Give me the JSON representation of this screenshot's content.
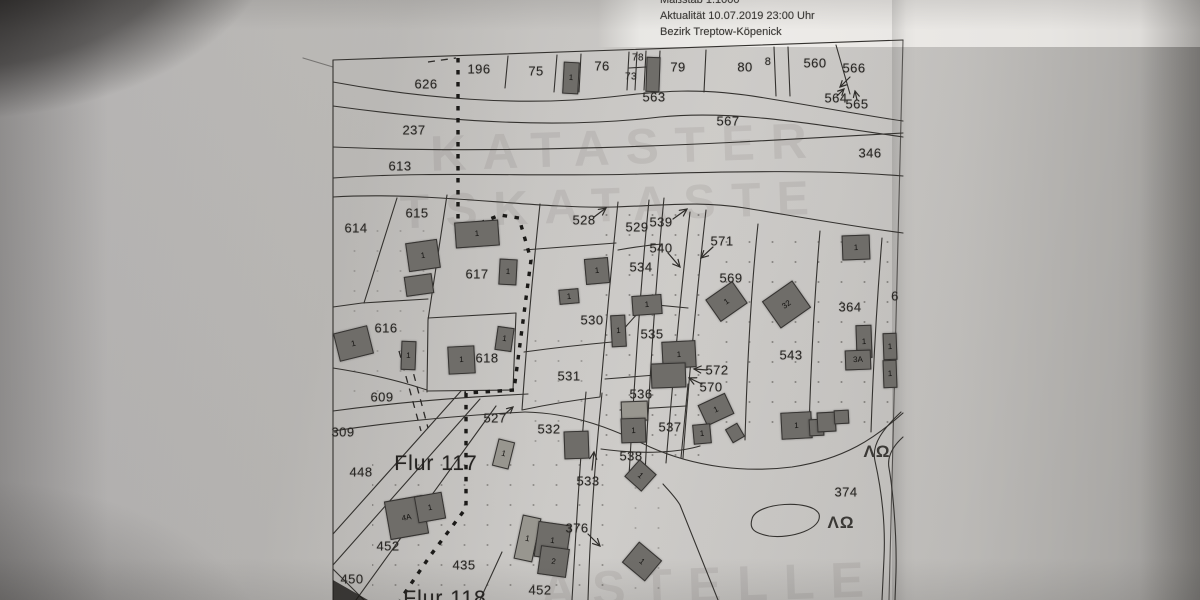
{
  "header": {
    "masstab": "Maßstab 1:1000",
    "aktualitaet": "Aktualität 10.07.2019 23:00 Uhr",
    "bezirk": "Bezirk Treptow-Köpenick"
  },
  "colors": {
    "ink": "#34322f",
    "building_fill": "#6f6d69",
    "paper": "#c8c6c3"
  },
  "map": {
    "flur_labels": [
      {
        "t": "Flur 117",
        "x": 436,
        "y": 464
      },
      {
        "t": "Flur 118",
        "x": 445,
        "y": 599
      }
    ],
    "parcel_labels": [
      {
        "t": "626",
        "x": 426,
        "y": 84
      },
      {
        "t": "196",
        "x": 479,
        "y": 69
      },
      {
        "t": "75",
        "x": 536,
        "y": 71
      },
      {
        "t": "76",
        "x": 602,
        "y": 66
      },
      {
        "t": "78",
        "x": 638,
        "y": 58,
        "s": 10
      },
      {
        "t": "73",
        "x": 631,
        "y": 77,
        "s": 10
      },
      {
        "t": "79",
        "x": 678,
        "y": 67
      },
      {
        "t": "80",
        "x": 745,
        "y": 67
      },
      {
        "t": "8",
        "x": 768,
        "y": 62,
        "s": 11
      },
      {
        "t": "560",
        "x": 815,
        "y": 63
      },
      {
        "t": "566",
        "x": 854,
        "y": 68
      },
      {
        "t": "563",
        "x": 654,
        "y": 97
      },
      {
        "t": "564",
        "x": 836,
        "y": 98
      },
      {
        "t": "565",
        "x": 857,
        "y": 104
      },
      {
        "t": "567",
        "x": 728,
        "y": 121
      },
      {
        "t": "237",
        "x": 414,
        "y": 130
      },
      {
        "t": "613",
        "x": 400,
        "y": 166
      },
      {
        "t": "346",
        "x": 870,
        "y": 153
      },
      {
        "t": "614",
        "x": 356,
        "y": 228
      },
      {
        "t": "615",
        "x": 417,
        "y": 213
      },
      {
        "t": "528",
        "x": 584,
        "y": 220
      },
      {
        "t": "529",
        "x": 637,
        "y": 227
      },
      {
        "t": "539",
        "x": 661,
        "y": 222
      },
      {
        "t": "540",
        "x": 661,
        "y": 248
      },
      {
        "t": "571",
        "x": 722,
        "y": 241
      },
      {
        "t": "534",
        "x": 641,
        "y": 267
      },
      {
        "t": "617",
        "x": 477,
        "y": 274
      },
      {
        "t": "569",
        "x": 731,
        "y": 278
      },
      {
        "t": "364",
        "x": 850,
        "y": 307
      },
      {
        "t": "616",
        "x": 386,
        "y": 328
      },
      {
        "t": "530",
        "x": 592,
        "y": 320
      },
      {
        "t": "535",
        "x": 652,
        "y": 334
      },
      {
        "t": "618",
        "x": 487,
        "y": 358
      },
      {
        "t": "543",
        "x": 791,
        "y": 355
      },
      {
        "t": "531",
        "x": 569,
        "y": 376
      },
      {
        "t": "572",
        "x": 717,
        "y": 370
      },
      {
        "t": "570",
        "x": 711,
        "y": 387
      },
      {
        "t": "609",
        "x": 382,
        "y": 397
      },
      {
        "t": "536",
        "x": 641,
        "y": 394
      },
      {
        "t": "527",
        "x": 495,
        "y": 418
      },
      {
        "t": "532",
        "x": 549,
        "y": 429
      },
      {
        "t": "537",
        "x": 670,
        "y": 427
      },
      {
        "t": "309",
        "x": 343,
        "y": 432
      },
      {
        "t": "538",
        "x": 631,
        "y": 456
      },
      {
        "t": "448",
        "x": 361,
        "y": 472
      },
      {
        "t": "533",
        "x": 588,
        "y": 481
      },
      {
        "t": "374",
        "x": 846,
        "y": 492
      },
      {
        "t": "376",
        "x": 577,
        "y": 528
      },
      {
        "t": "452",
        "x": 388,
        "y": 546
      },
      {
        "t": "435",
        "x": 464,
        "y": 565
      },
      {
        "t": "450",
        "x": 352,
        "y": 579
      },
      {
        "t": "452",
        "x": 540,
        "y": 590
      },
      {
        "t": "6",
        "x": 895,
        "y": 296
      }
    ],
    "symbols": [
      {
        "t": "ΛΩ",
        "x": 877,
        "y": 452
      },
      {
        "t": "ΛΩ",
        "x": 841,
        "y": 523
      }
    ],
    "watermarks": [
      {
        "t": "KATASTER",
        "x": 430,
        "y": 118,
        "s": 50,
        "r": -2
      },
      {
        "t": "TSKATASTE",
        "x": 400,
        "y": 178,
        "s": 48,
        "r": -2
      },
      {
        "t": "ASTELLE",
        "x": 540,
        "y": 556,
        "s": 50,
        "r": -2
      }
    ],
    "buildings": [
      {
        "x": 563,
        "y": 62,
        "w": 14,
        "h": 30,
        "r": 3,
        "l": "1"
      },
      {
        "x": 646,
        "y": 57,
        "w": 12,
        "h": 33,
        "r": 2,
        "l": ""
      },
      {
        "x": 455,
        "y": 221,
        "w": 42,
        "h": 24,
        "r": -4,
        "l": "1"
      },
      {
        "x": 499,
        "y": 259,
        "w": 16,
        "h": 24,
        "r": 3,
        "l": "1"
      },
      {
        "x": 407,
        "y": 241,
        "w": 30,
        "h": 27,
        "r": -8,
        "l": "1"
      },
      {
        "x": 405,
        "y": 275,
        "w": 26,
        "h": 18,
        "r": -8,
        "l": ""
      },
      {
        "x": 336,
        "y": 329,
        "w": 33,
        "h": 27,
        "r": -14,
        "l": "1"
      },
      {
        "x": 401,
        "y": 341,
        "w": 13,
        "h": 27,
        "r": 2,
        "l": "1"
      },
      {
        "x": 448,
        "y": 346,
        "w": 25,
        "h": 26,
        "r": -3,
        "l": "1"
      },
      {
        "x": 496,
        "y": 327,
        "w": 15,
        "h": 22,
        "r": 8,
        "l": "1"
      },
      {
        "x": 585,
        "y": 258,
        "w": 22,
        "h": 24,
        "r": -5,
        "l": "1"
      },
      {
        "x": 559,
        "y": 289,
        "w": 18,
        "h": 13,
        "r": -5,
        "l": "1"
      },
      {
        "x": 611,
        "y": 315,
        "w": 13,
        "h": 30,
        "r": -3,
        "l": "1"
      },
      {
        "x": 632,
        "y": 295,
        "w": 28,
        "h": 18,
        "r": -4,
        "l": "1"
      },
      {
        "x": 662,
        "y": 341,
        "w": 32,
        "h": 25,
        "r": -3,
        "l": "1"
      },
      {
        "x": 651,
        "y": 363,
        "w": 33,
        "h": 23,
        "r": -2,
        "l": ""
      },
      {
        "x": 710,
        "y": 288,
        "w": 31,
        "h": 25,
        "r": -35,
        "l": "1"
      },
      {
        "x": 768,
        "y": 288,
        "w": 35,
        "h": 31,
        "r": -35,
        "l": "32"
      },
      {
        "x": 842,
        "y": 235,
        "w": 26,
        "h": 23,
        "r": -2,
        "l": "1"
      },
      {
        "x": 856,
        "y": 325,
        "w": 14,
        "h": 31,
        "r": -2,
        "l": "1"
      },
      {
        "x": 845,
        "y": 350,
        "w": 24,
        "h": 18,
        "r": -2,
        "l": "3A"
      },
      {
        "x": 883,
        "y": 333,
        "w": 12,
        "h": 25,
        "r": -2,
        "l": "1"
      },
      {
        "x": 883,
        "y": 360,
        "w": 12,
        "h": 26,
        "r": -2,
        "l": "1"
      },
      {
        "x": 701,
        "y": 398,
        "w": 28,
        "h": 21,
        "r": -25,
        "l": "1"
      },
      {
        "x": 693,
        "y": 424,
        "w": 16,
        "h": 18,
        "r": -5,
        "l": "1"
      },
      {
        "x": 728,
        "y": 425,
        "w": 12,
        "h": 14,
        "r": -30,
        "l": ""
      },
      {
        "x": 621,
        "y": 401,
        "w": 25,
        "h": 18,
        "r": -2,
        "l": "",
        "light": true
      },
      {
        "x": 621,
        "y": 418,
        "w": 23,
        "h": 23,
        "r": -2,
        "l": "1"
      },
      {
        "x": 564,
        "y": 431,
        "w": 23,
        "h": 26,
        "r": -2,
        "l": ""
      },
      {
        "x": 629,
        "y": 464,
        "w": 21,
        "h": 21,
        "r": 42,
        "l": "1"
      },
      {
        "x": 495,
        "y": 440,
        "w": 15,
        "h": 26,
        "r": 14,
        "l": "1",
        "light": true
      },
      {
        "x": 387,
        "y": 498,
        "w": 37,
        "h": 37,
        "r": -10,
        "l": "4A"
      },
      {
        "x": 416,
        "y": 494,
        "w": 26,
        "h": 25,
        "r": -10,
        "l": "1"
      },
      {
        "x": 518,
        "y": 516,
        "w": 17,
        "h": 43,
        "r": 12,
        "l": "1",
        "light": true
      },
      {
        "x": 536,
        "y": 523,
        "w": 31,
        "h": 34,
        "r": 8,
        "l": "1"
      },
      {
        "x": 539,
        "y": 547,
        "w": 27,
        "h": 27,
        "r": 8,
        "l": "2"
      },
      {
        "x": 627,
        "y": 548,
        "w": 28,
        "h": 25,
        "r": 40,
        "l": "1"
      },
      {
        "x": 781,
        "y": 412,
        "w": 29,
        "h": 25,
        "r": -3,
        "l": "1"
      },
      {
        "x": 809,
        "y": 419,
        "w": 13,
        "h": 15,
        "r": -3,
        "l": ""
      },
      {
        "x": 817,
        "y": 412,
        "w": 17,
        "h": 18,
        "r": -3,
        "l": ""
      },
      {
        "x": 834,
        "y": 410,
        "w": 13,
        "h": 12,
        "r": -3,
        "l": ""
      }
    ]
  }
}
